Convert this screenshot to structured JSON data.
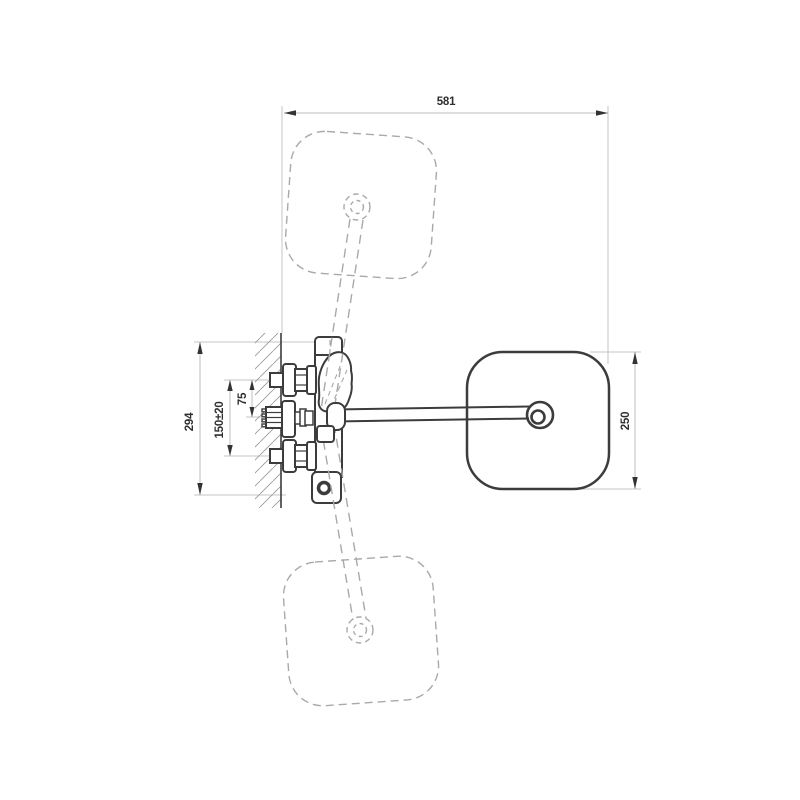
{
  "title": "wall-mounted-mixer-tap-technical-drawing",
  "dimensions": {
    "total_width": "581",
    "wall_height": "294",
    "connection_spacing": "150±20",
    "spout_offset": "75",
    "head_width": "250"
  },
  "colors": {
    "outline": "#3c3c3c",
    "hidden_dashed": "#a9a9a9",
    "dimension_line": "#bdbdbd",
    "label_text": "#2e2e2e",
    "background": "#ffffff"
  }
}
